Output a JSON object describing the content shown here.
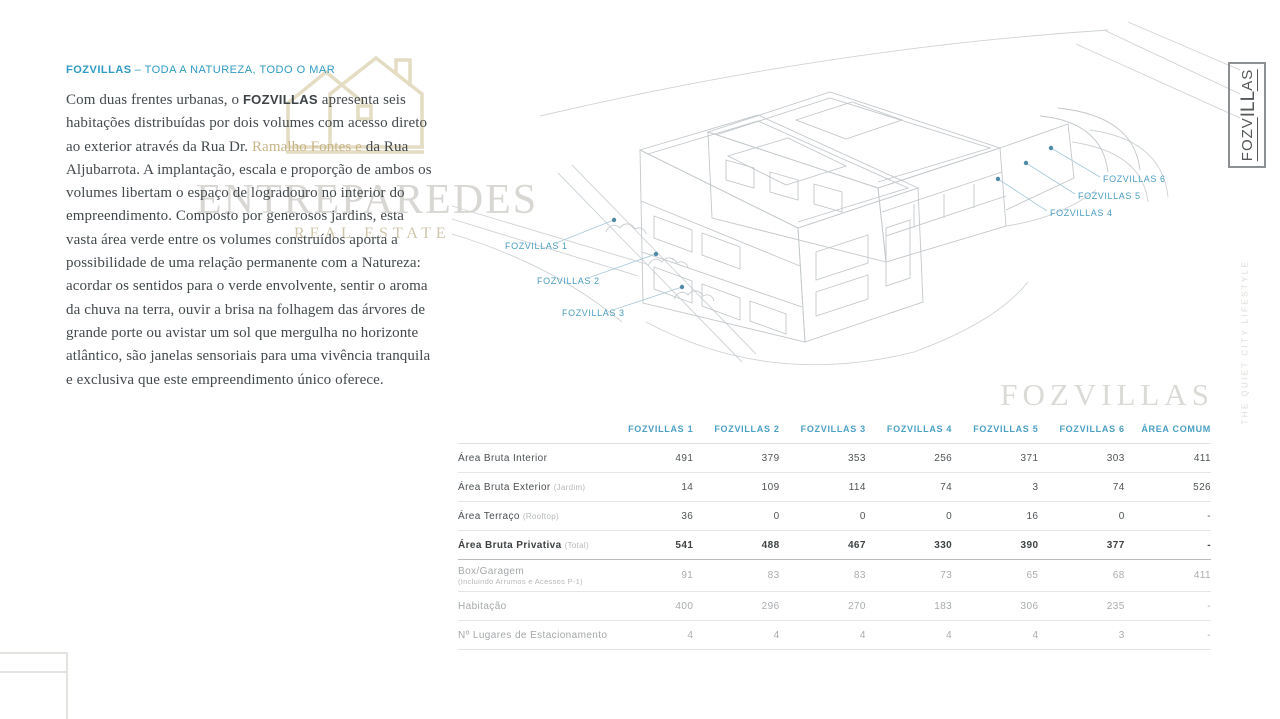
{
  "colors": {
    "accent_blue": "#3a9cc4",
    "gold": "#c9b488",
    "watermark_gray": "#d8d7d3",
    "sketch_line": "#c5cacd"
  },
  "header": {
    "brand": "FOZVILLAS",
    "tagline": "– TODA A NATUREZA, TODO O MAR"
  },
  "intro": {
    "p1": "Com duas frentes urbanas, o ",
    "brand": "FOZVILLAS",
    "p2": " apresenta seis habitações distribuídas por dois volumes com acesso direto ao exterior através da Rua Dr. ",
    "street": "Ramalho Fontes e",
    "p3": " da Rua Aljubarrota. A implantação, escala e proporção de ambos os volumes libertam o espaço de logradouro no interior do empreendimento. Composto por generosos jardins, esta vasta área verde entre os volumes construídos aporta a possibilidade de uma relação permanente com a Natureza: acordar os sentidos para o verde envolvente, sentir o aroma da chuva na terra, ouvir a brisa na folhagem das árvores de grande porte ou avistar um sol que mergulha no horizonte atlântico, são janelas sensoriais para uma vivência tranquila e exclusiva que este empreendimento único oferece."
  },
  "watermark": {
    "title": "ENTREPAREDES",
    "subtitle": "REAL ESTATE",
    "icon": "entreparedes-houses-icon"
  },
  "side": {
    "logo_part1": "FOZV",
    "logo_part2": "ILL",
    "logo_part3": "AS",
    "vertical_text": "THE QUIET CITY LIFESTYLE"
  },
  "drawing": {
    "labels": [
      {
        "text": "FOZVILLAS 1"
      },
      {
        "text": "FOZVILLAS 2"
      },
      {
        "text": "FOZVILLAS 3"
      },
      {
        "text": "FOZVILLAS 4"
      },
      {
        "text": "FOZVILLAS 5"
      },
      {
        "text": "FOZVILLAS 6"
      }
    ]
  },
  "section_title": "FOZVILLAS",
  "table": {
    "columns": [
      "FOZVILLAS 1",
      "FOZVILLAS 2",
      "FOZVILLAS 3",
      "FOZVILLAS 4",
      "FOZVILLAS 5",
      "FOZVILLAS 6",
      "ÁREA COMUM"
    ],
    "rows": [
      {
        "label": "Área Bruta Interior",
        "sub": "",
        "values": [
          "491",
          "379",
          "353",
          "256",
          "371",
          "303",
          "411"
        ]
      },
      {
        "label": "Área Bruta Exterior",
        "sub": "(Jardim)",
        "values": [
          "14",
          "109",
          "114",
          "74",
          "3",
          "74",
          "526"
        ]
      },
      {
        "label": "Área Terraço",
        "sub": "(Rooftop)",
        "values": [
          "36",
          "0",
          "0",
          "0",
          "16",
          "0",
          "-"
        ]
      },
      {
        "label": "Área Bruta Privativa",
        "sub": "(Total)",
        "values": [
          "541",
          "488",
          "467",
          "330",
          "390",
          "377",
          "-"
        ]
      },
      {
        "label": "Box/Garagem",
        "sub": "(Incluindo Arrumos e Acessos P-1)",
        "values": [
          "91",
          "83",
          "83",
          "73",
          "65",
          "68",
          "411"
        ]
      },
      {
        "label": "Habitação",
        "sub": "",
        "values": [
          "400",
          "296",
          "270",
          "183",
          "306",
          "235",
          "-"
        ]
      },
      {
        "label": "Nº Lugares de Estacionamento",
        "sub": "",
        "values": [
          "4",
          "4",
          "4",
          "4",
          "4",
          "3",
          "-"
        ]
      }
    ]
  }
}
